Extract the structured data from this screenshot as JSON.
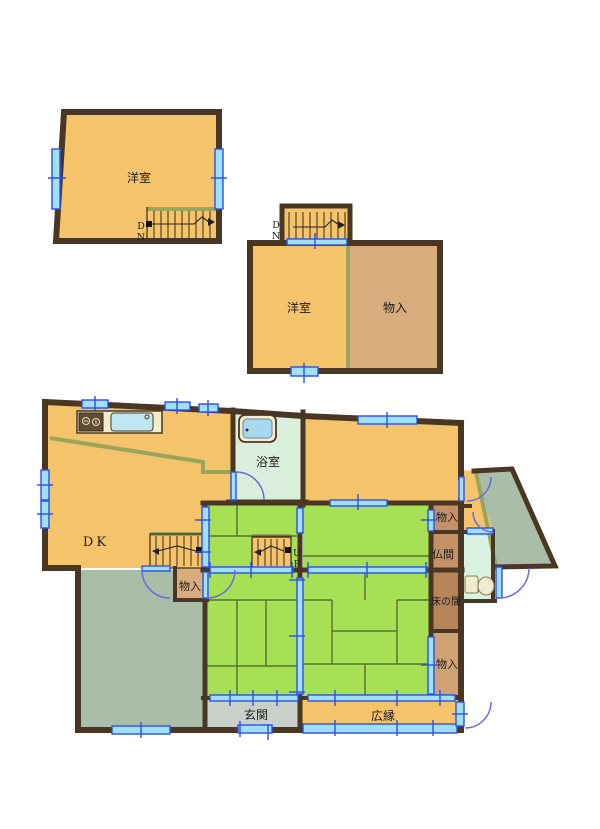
{
  "title": "Japanese house floor plan",
  "colors": {
    "wall": "#4a3723",
    "room_orange": "#f5c36a",
    "closet_tan": "#d8ac7c",
    "closet_brown": "#c49167",
    "tokonoma_brown": "#b8855a",
    "closet_light_tan": "#cfa273",
    "tatami_green": "#a6e054",
    "tatami_line": "#55722e",
    "earth_gray_green": "#a9bda9",
    "bath_pale_green": "#d9efdc",
    "toilet_pale_mint": "#d9f1e1",
    "entrance_gray": "#c9cfc9",
    "window_blue": "#2b50e8",
    "window_cyan": "#9fe0f7",
    "door_arc_blue": "#6a6ae0",
    "accent_olive": "#9aa55c",
    "fixture_cream": "#f3eccf",
    "water_blue": "#a8d8f0"
  },
  "floor2_left": {
    "room": "洋室",
    "down_d": "D",
    "down_n": "N"
  },
  "floor2_right": {
    "room": "洋室",
    "closet": "物入",
    "down_d": "D",
    "down_n": "N"
  },
  "floor1": {
    "dk": "DK",
    "bath": "浴室",
    "up_u": "U",
    "up_p": "P",
    "closet_hall": "物入",
    "closet_ne": "物入",
    "butsuma": "仏間",
    "tokonoma": "床の間",
    "closet_se": "物入",
    "toilet": "トイレ",
    "entrance": "玄関",
    "veranda": "広縁"
  }
}
